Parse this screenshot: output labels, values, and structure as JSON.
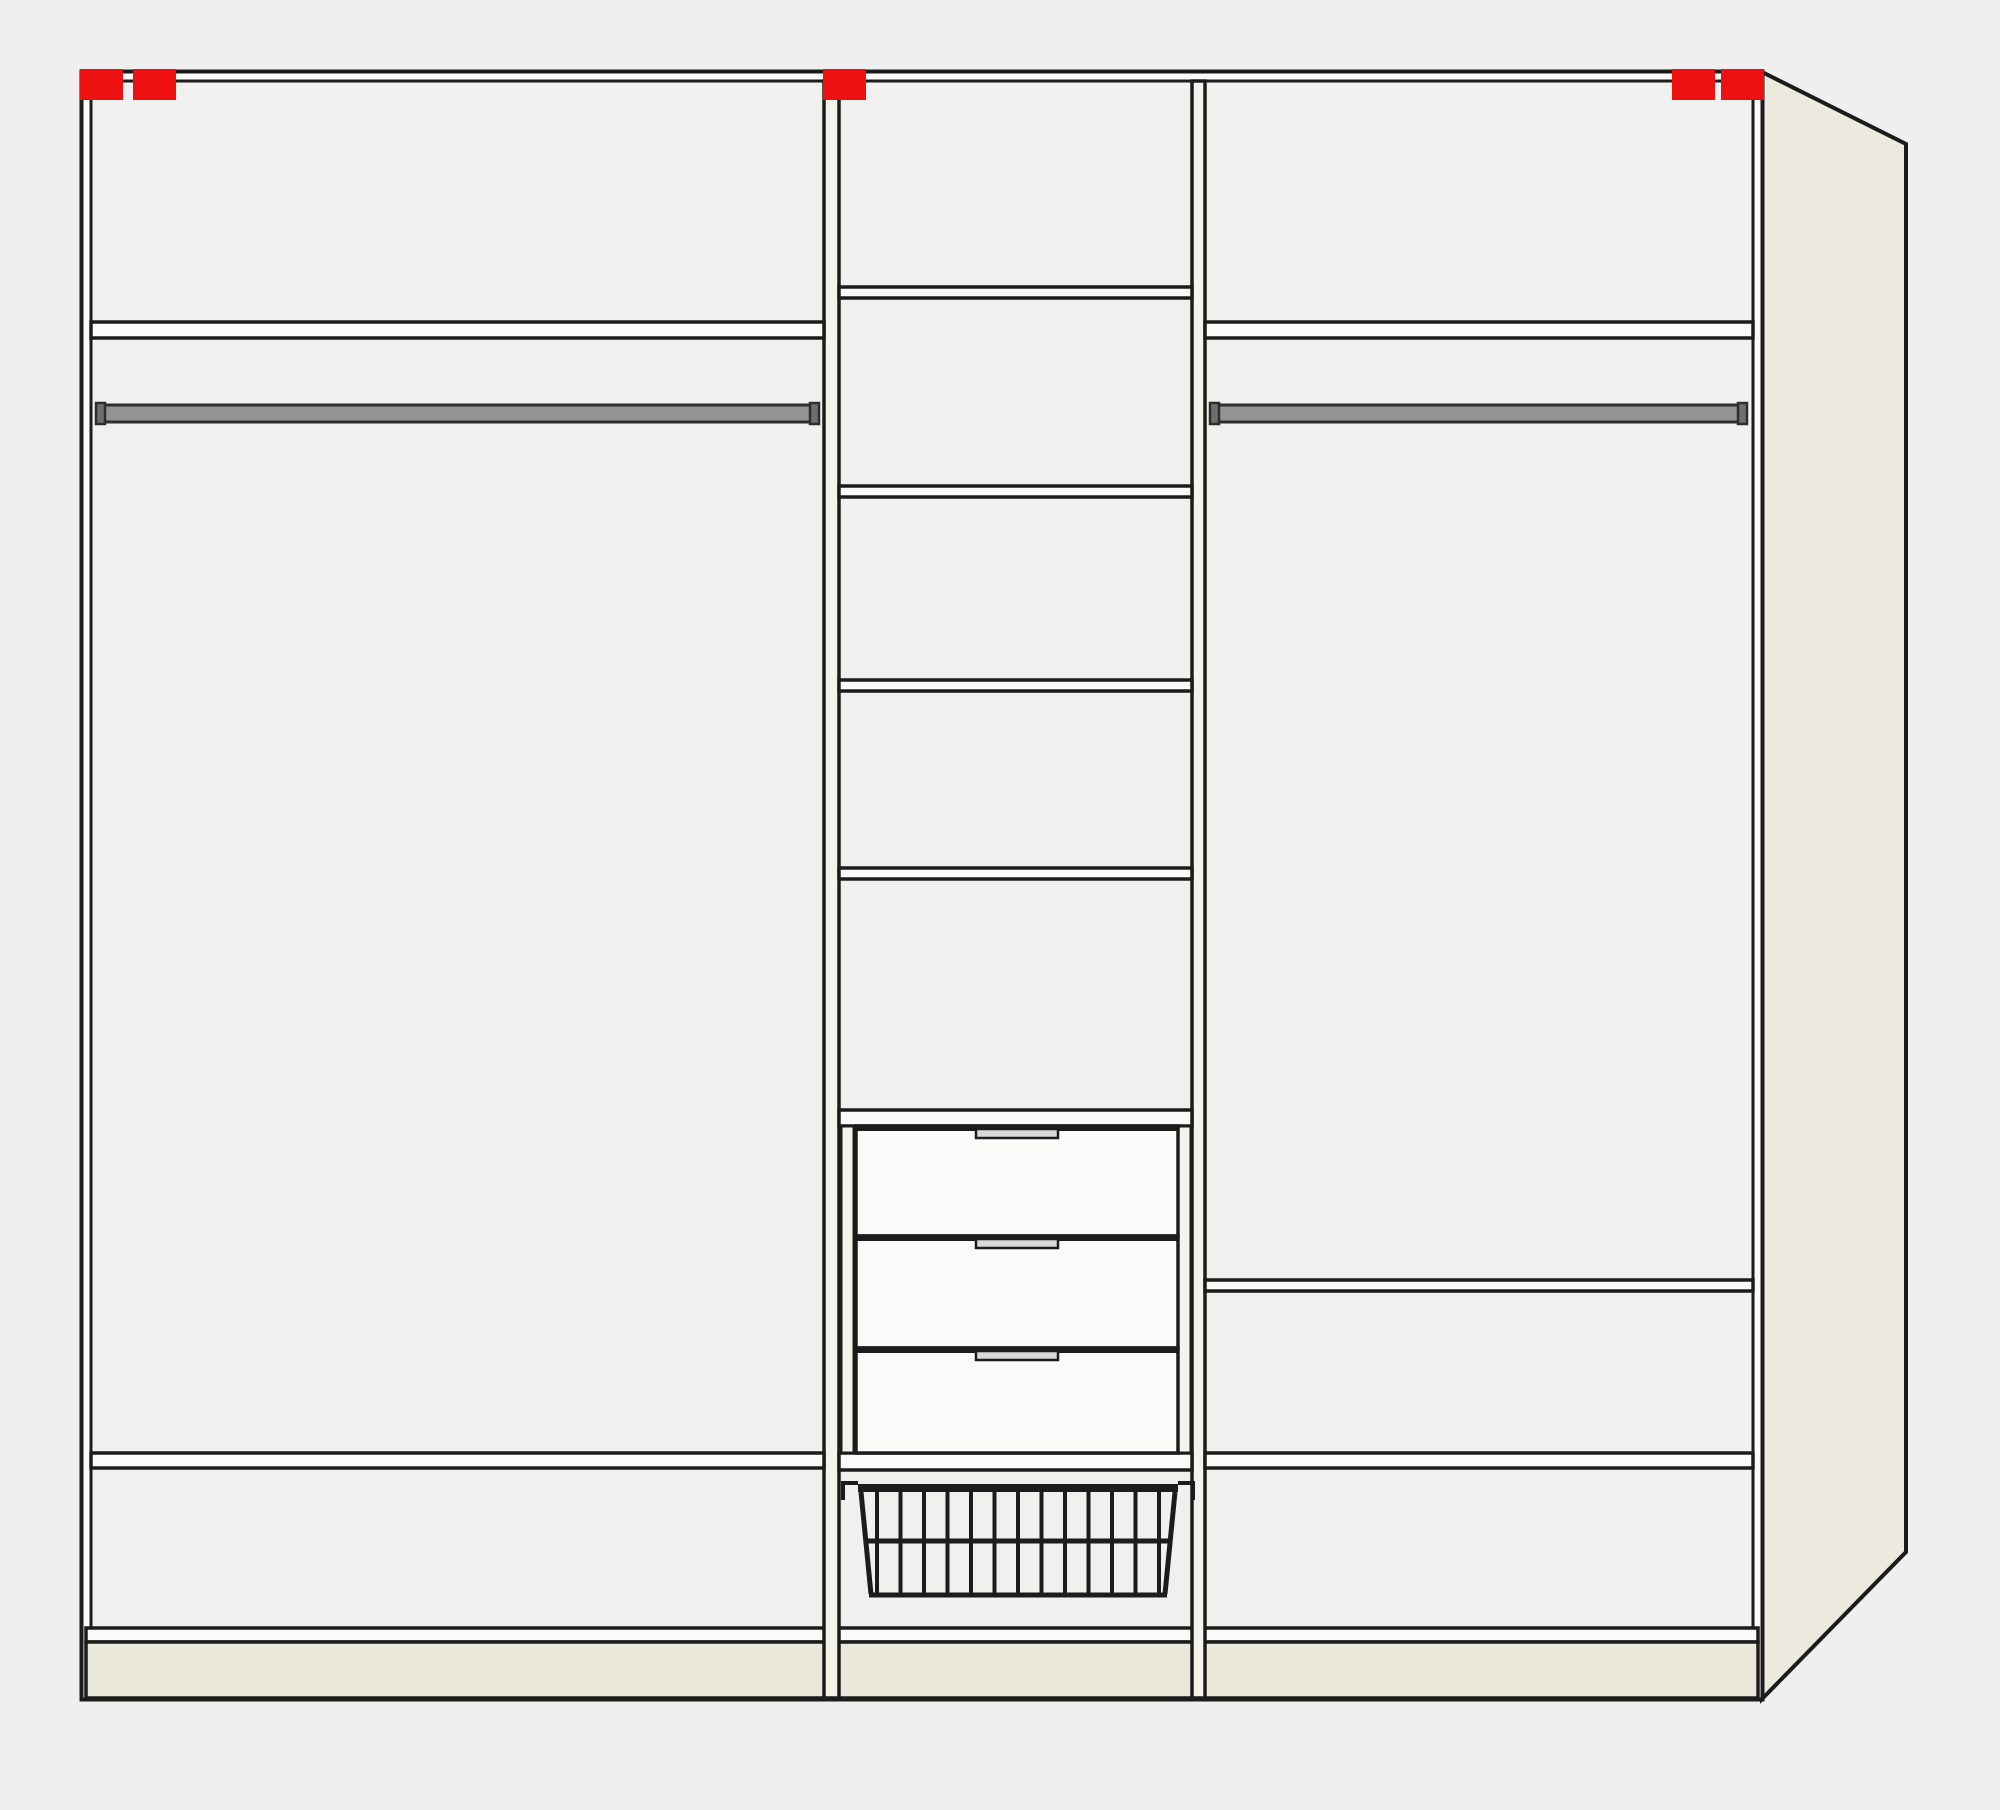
{
  "diagram": {
    "kind": "wardrobe-interior-configuration",
    "canvas": {
      "width": 2000,
      "height": 1810
    },
    "colors": {
      "background": "#efefef",
      "interior": "#f0f1ee",
      "board": "#fafaf8",
      "trim": "#f4f3ec",
      "plinth": "#eae7db",
      "side_panel": "#ece9de",
      "line": "#1c1c1c",
      "rail": "#939393",
      "rail_cap": "#6e6e6e",
      "handle": "#d8d8d8",
      "marker_red": "#ee1111"
    },
    "frame": {
      "x": 82,
      "y": 72,
      "w": 1680,
      "h": 1627,
      "edge": 9
    },
    "side_panel": {
      "points": "1762,72 1906,144 1906,1552 1762,1699"
    },
    "base": {
      "x": 86,
      "w": 1672,
      "board_y": 1628,
      "board_h": 14,
      "plinth_y": 1642,
      "plinth_h": 56
    },
    "partitions": [
      {
        "x": 824,
        "w": 15
      },
      {
        "x": 1192,
        "w": 13
      }
    ],
    "markers": {
      "y": 69,
      "w": 43,
      "h": 31,
      "xs": [
        80,
        133,
        823,
        1672,
        1721
      ]
    },
    "sections": {
      "left": {
        "x1": 91,
        "x2": 824,
        "shelves": [
          {
            "y": 322,
            "h": 16
          },
          {
            "y": 1453,
            "h": 15
          }
        ],
        "rail": {
          "x1": 97,
          "x2": 818,
          "y": 405,
          "h": 17
        }
      },
      "middle": {
        "x1": 839,
        "x2": 1192,
        "shelves": [
          {
            "y": 287,
            "h": 11
          },
          {
            "y": 486,
            "h": 11
          },
          {
            "y": 680,
            "h": 11
          },
          {
            "y": 868,
            "h": 11
          }
        ],
        "top_board": {
          "y": 1110,
          "h": 16
        },
        "bottom_board": {
          "y": 1453,
          "h": 17
        },
        "drawer_rails": [
          {
            "x": 841,
            "w": 13
          },
          {
            "x": 1178,
            "w": 13
          }
        ],
        "drawers": {
          "front_x1": 856,
          "front_x2": 1178,
          "items": [
            {
              "y": 1126,
              "h": 110
            },
            {
              "y": 1236,
              "h": 112
            },
            {
              "y": 1348,
              "h": 105
            }
          ],
          "handle": {
            "w": 82,
            "h": 9
          }
        },
        "basket": {
          "top_y": 1487,
          "top_x1": 858,
          "top_x2": 1178,
          "bottom_y": 1595,
          "bottom_x1": 870,
          "bottom_x2": 1166,
          "mid_y": 1541,
          "wires": 13
        }
      },
      "right": {
        "x1": 1205,
        "x2": 1753,
        "shelves": [
          {
            "y": 322,
            "h": 16
          },
          {
            "y": 1280,
            "h": 11
          },
          {
            "y": 1453,
            "h": 15
          }
        ],
        "rail": {
          "x1": 1211,
          "x2": 1746,
          "y": 405,
          "h": 17
        }
      }
    }
  }
}
